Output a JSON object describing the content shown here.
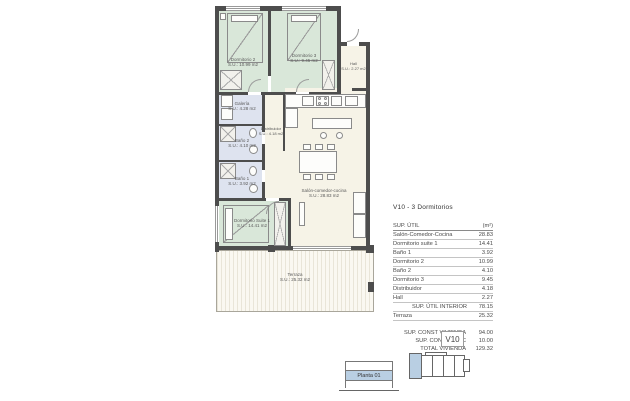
{
  "area_table": {
    "title": "V10 - 3 Dormitorios",
    "header": {
      "label": "SUP. ÚTIL",
      "unit": "(m²)"
    },
    "rows": [
      {
        "label": "Salón-Comedor-Cocina",
        "value": "28.83"
      },
      {
        "label": "Dormitorio suite 1",
        "value": "14.41"
      },
      {
        "label": "Baño 1",
        "value": "3.92"
      },
      {
        "label": "Dormitorio 2",
        "value": "10.99"
      },
      {
        "label": "Baño 2",
        "value": "4.10"
      },
      {
        "label": "Dormitorio 3",
        "value": "9.45"
      },
      {
        "label": "Distribuidor",
        "value": "4.18"
      },
      {
        "label": "Hall",
        "value": "2.27"
      },
      {
        "label": "SUP. ÚTIL INTERIOR",
        "value": "78.15"
      },
      {
        "label": "Terraza",
        "value": "25.32"
      }
    ],
    "summary": [
      {
        "label": "SUP. CONST VIVIENDA",
        "value": "94.00"
      },
      {
        "label": "SUP. CONST ZZCC",
        "value": "10.00"
      },
      {
        "label": "TOTAL VIVIENDA",
        "value": "129.32"
      }
    ]
  },
  "plan": {
    "rooms": {
      "dormitorio2": {
        "name": "Dormitorio 2",
        "area": "S.U.: 10.99 m2"
      },
      "dormitorio3": {
        "name": "Dormitorio 3",
        "area": "S.U.: 9.45 m2"
      },
      "hall": {
        "name": "Hall",
        "area": "S.U.: 2.27 m2"
      },
      "galeria": {
        "name": "Galería",
        "area": "S.U.: 4.28 m2"
      },
      "bano2": {
        "name": "Baño 2",
        "area": "S.U.: 4.10 m2"
      },
      "bano1": {
        "name": "Baño 1",
        "area": "S.U.: 3.92 m2"
      },
      "distribuidor": {
        "name": "Distribuidor",
        "area": "S.U.: 4.18 m2"
      },
      "salon": {
        "name": "Salón-comedor-cocina",
        "area": "S.U.: 28.83 m2"
      },
      "suite": {
        "name": "Dormitorio Suite 1",
        "area": "S.U.: 14.41 m2"
      },
      "terraza": {
        "name": "Terraza",
        "area": "S.U.: 25.32 m2"
      }
    }
  },
  "key_plan": {
    "unit_label": "V10"
  },
  "floor_selector": {
    "label": "Planta 01"
  },
  "colors": {
    "wall": "#4d4d4d",
    "bedroom_fill": "#d9e7d9",
    "bath_fill": "#dee3ef",
    "living_fill": "#f6f3e7",
    "highlight_blue": "#b9cfe3"
  }
}
